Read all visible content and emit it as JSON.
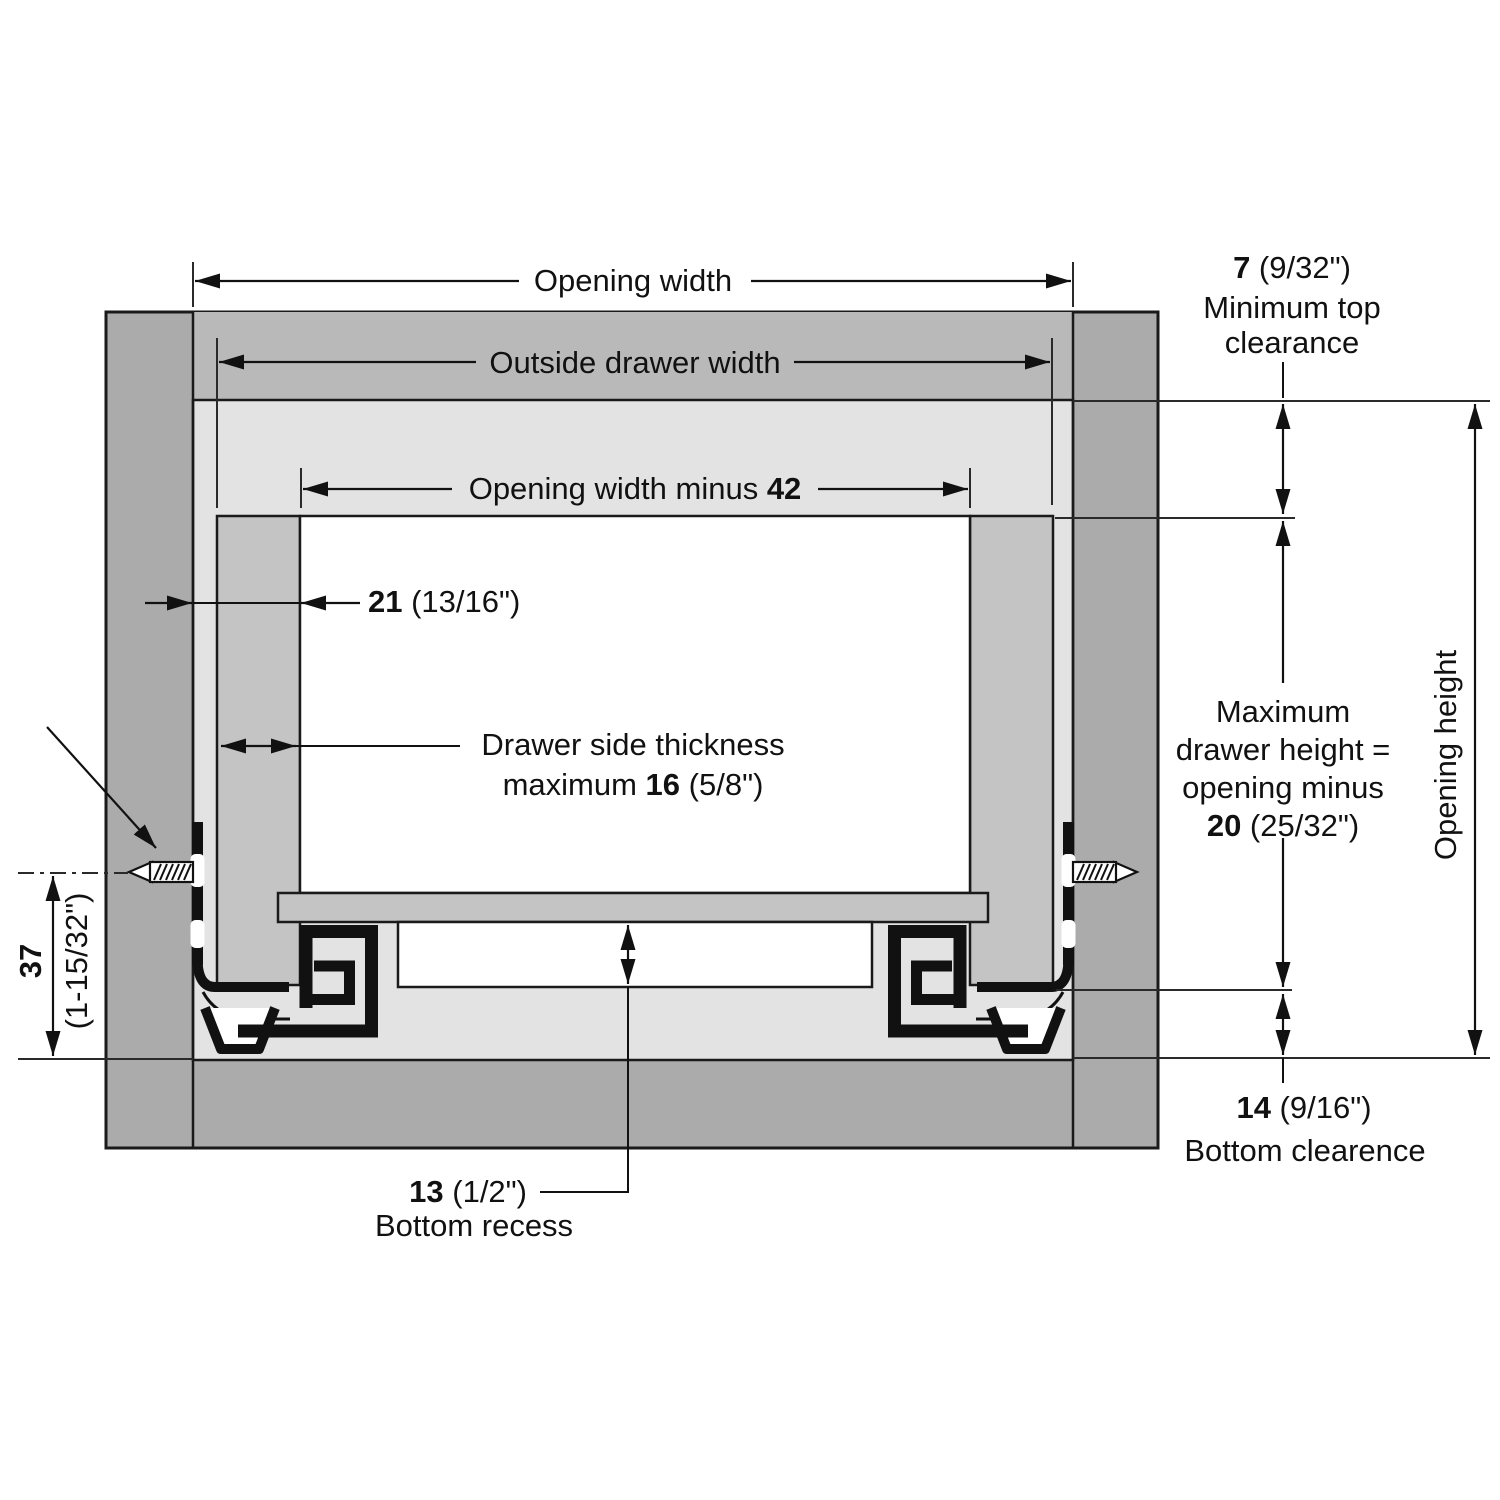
{
  "diagram": "drawer-slide installation cross-section",
  "labels": {
    "opening_width": "Opening width",
    "outside_drawer_width": "Outside drawer width",
    "inner_width": {
      "prefix": "Opening width minus ",
      "value": "42"
    },
    "side_gap": {
      "value": "21",
      "suffix": " (13/16\")"
    },
    "side_thickness": {
      "line1": "Drawer side thickness",
      "prefix": "maximum ",
      "value": "16",
      "suffix": " (5/8\")"
    },
    "top_clearance": {
      "value": "7",
      "suffix": " (9/32\")",
      "line2": "Minimum top",
      "line3": "clearance"
    },
    "max_drawer_height": {
      "line1": "Maximum",
      "line2": "drawer height =",
      "line3": "opening minus",
      "value": "20",
      "suffix": " (25/32\")"
    },
    "opening_height": "Opening height",
    "bottom_clearance": {
      "value": "14",
      "suffix": " (9/16\")",
      "line2": "Bottom clearence"
    },
    "bottom_recess": {
      "value": "13",
      "suffix": " (1/2\")",
      "line2": "Bottom recess"
    },
    "mounting_height": {
      "value": "37",
      "suffix": "(1-15/32\")"
    }
  },
  "colors": {
    "background": "#ffffff",
    "cabinet_frame": "#ababab",
    "cabinet_top_rail": "#b9b9b9",
    "opening": "#e3e3e3",
    "drawer_parts": "#c4c4c4",
    "outline": "#111111"
  }
}
